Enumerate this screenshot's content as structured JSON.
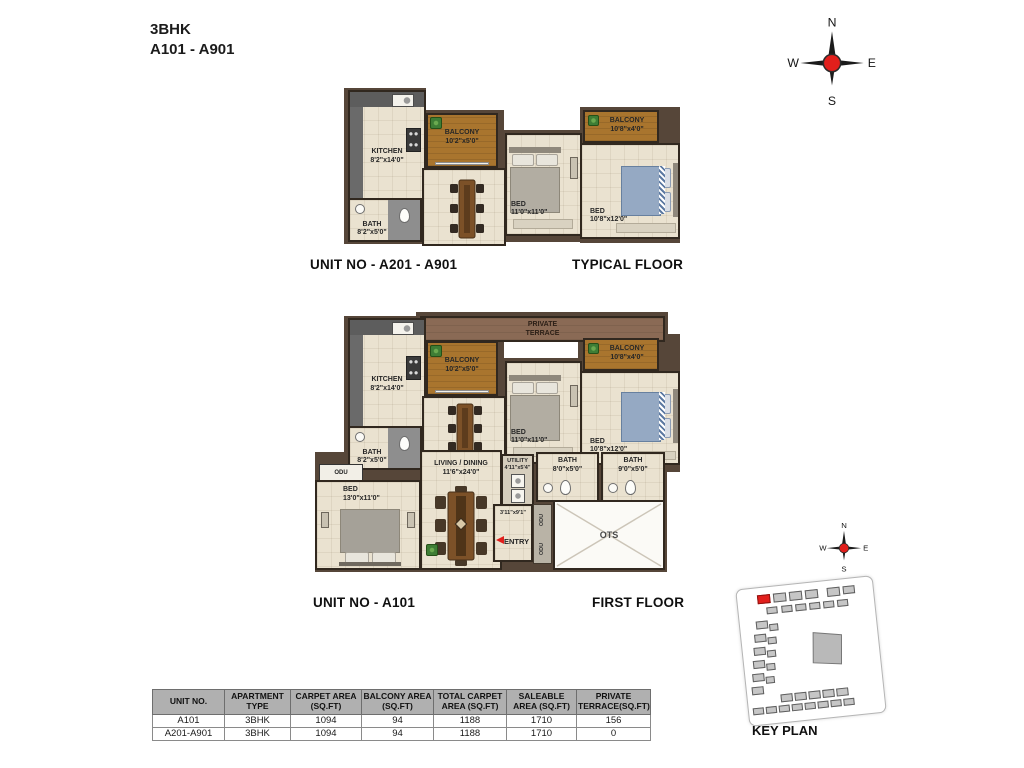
{
  "title": {
    "line1": "3BHK",
    "line2": "A101 - A901"
  },
  "compass": {
    "n": "N",
    "e": "E",
    "s": "S",
    "w": "W"
  },
  "plans": {
    "typical": {
      "unit_label": "UNIT NO - A201 - A901",
      "floor_label": "TYPICAL FLOOR",
      "rooms": {
        "kitchen": {
          "name": "KITCHEN",
          "dim": "8'2\"x14'0\""
        },
        "bath": {
          "name": "BATH",
          "dim": "8'2\"x5'0\""
        },
        "balcony1": {
          "name": "BALCONY",
          "dim": "10'2\"x5'0\""
        },
        "bed1": {
          "name": "BED",
          "dim": "11'0\"x11'0\""
        },
        "balcony2": {
          "name": "BALCONY",
          "dim": "10'8\"x4'0\""
        },
        "bed2": {
          "name": "BED",
          "dim": "10'8\"x12'0\""
        }
      }
    },
    "first": {
      "unit_label": "UNIT NO - A101",
      "floor_label": "FIRST FLOOR",
      "rooms": {
        "terrace": {
          "name": "PRIVATE TERRACE"
        },
        "kitchen": {
          "name": "KITCHEN",
          "dim": "8'2\"x14'0\""
        },
        "bath": {
          "name": "BATH",
          "dim": "8'2\"x5'0\""
        },
        "balcony1": {
          "name": "BALCONY",
          "dim": "10'2\"x5'0\""
        },
        "bed1": {
          "name": "BED",
          "dim": "11'0\"x11'0\""
        },
        "balcony2": {
          "name": "BALCONY",
          "dim": "10'8\"x4'0\""
        },
        "bed2": {
          "name": "BED",
          "dim": "10'8\"x12'0\""
        },
        "bed3": {
          "name": "BED",
          "dim": "13'0\"x11'0\""
        },
        "living": {
          "name": "LIVING / DINING",
          "dim": "11'6\"x24'0\""
        },
        "utility": {
          "name": "UTILITY",
          "dim": "4'11\"x5'4\""
        },
        "bath2": {
          "name": "BATH",
          "dim": "8'0\"x5'0\""
        },
        "bath3": {
          "name": "BATH",
          "dim": "9'0\"x5'0\""
        },
        "ots": {
          "name": "OTS"
        },
        "entry": {
          "name": "ENTRY",
          "dim": "3'11\"x9'1\""
        },
        "odu_box": {
          "name": "ODU"
        },
        "odu_strip": [
          "ODU",
          "ODU"
        ]
      }
    }
  },
  "key_plan": {
    "label": "KEY PLAN"
  },
  "table": {
    "headers": [
      "UNIT NO.",
      "APARTMENT TYPE",
      "CARPET AREA (SQ.FT)",
      "BALCONY AREA (SQ.FT)",
      "TOTAL CARPET AREA (SQ.FT)",
      "SALEABLE AREA (SQ.FT)",
      "PRIVATE TERRACE(SQ.FT)"
    ],
    "rows": [
      [
        "A101",
        "3BHK",
        "1094",
        "94",
        "1188",
        "1710",
        "156"
      ],
      [
        "A201-A901",
        "3BHK",
        "1094",
        "94",
        "1188",
        "1710",
        "0"
      ]
    ]
  },
  "colors": {
    "accent_red": "#e21f1c",
    "balcony_brown": "#a9752e",
    "terrace_brown": "#8a6a55",
    "wall_brown": "#564639",
    "floor_cream": "#eae2d0",
    "table_header_gray": "#b0b0b0"
  }
}
